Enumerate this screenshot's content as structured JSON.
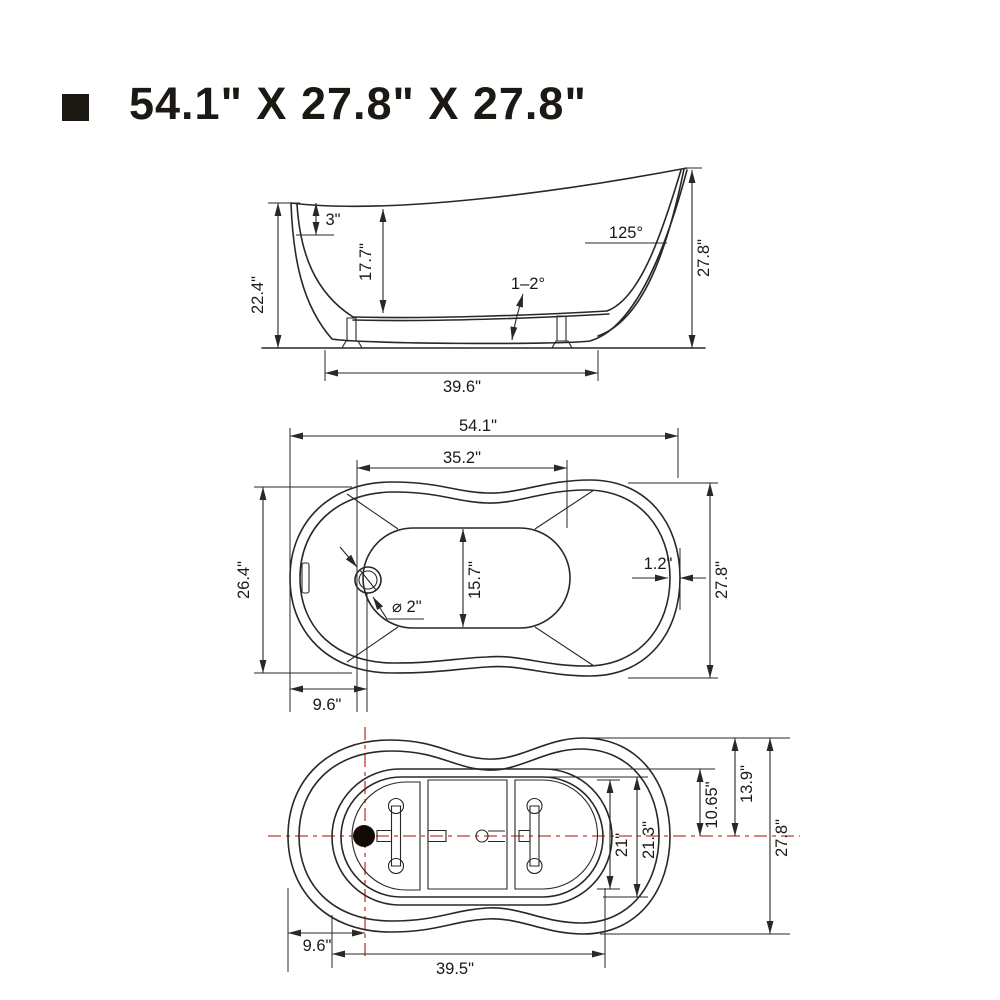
{
  "title": {
    "bullet": "square",
    "text": "54.1\" X 27.8\" X 27.8\""
  },
  "colors": {
    "line": "#2b2724",
    "text": "#1c1814",
    "centerline": "#c23a32",
    "drain_fill": "#140a05",
    "background": "#ffffff"
  },
  "product": {
    "overall_length_in": "54.1\"",
    "overall_width_in": "27.8\"",
    "overall_height_in": "27.8\""
  },
  "views": {
    "side": {
      "caption": "side-elevation-view",
      "labels": [
        {
          "text": "22.4\"",
          "x": 263,
          "y": 295,
          "rot": -90
        },
        {
          "text": "3\"",
          "x": 333,
          "y": 225,
          "rot": 0
        },
        {
          "text": "17.7\"",
          "x": 371,
          "y": 262,
          "rot": -90
        },
        {
          "text": "125°",
          "x": 626,
          "y": 238,
          "rot": 0
        },
        {
          "text": "1–2°",
          "x": 528,
          "y": 289,
          "rot": 0
        },
        {
          "text": "27.8\"",
          "x": 709,
          "y": 258,
          "rot": -90
        },
        {
          "text": "39.6\"",
          "x": 462,
          "y": 392,
          "rot": 0
        }
      ]
    },
    "plan": {
      "caption": "top-plan-view",
      "labels": [
        {
          "text": "54.1\"",
          "x": 478,
          "y": 431,
          "rot": 0
        },
        {
          "text": "35.2\"",
          "x": 462,
          "y": 463,
          "rot": 0
        },
        {
          "text": "26.4\"",
          "x": 249,
          "y": 580,
          "rot": -90
        },
        {
          "text": "15.7\"",
          "x": 480,
          "y": 580,
          "rot": -90
        },
        {
          "text": "⌀ 2\"",
          "x": 392,
          "y": 612,
          "rot": 0,
          "anchor": "start"
        },
        {
          "text": "1.2\"",
          "x": 658,
          "y": 569,
          "rot": 0
        },
        {
          "text": "27.8\"",
          "x": 727,
          "y": 580,
          "rot": -90
        },
        {
          "text": "9.6\"",
          "x": 327,
          "y": 710,
          "rot": 0
        }
      ]
    },
    "bottom": {
      "caption": "bottom-plan-view",
      "labels": [
        {
          "text": "21\"",
          "x": 627,
          "y": 845,
          "rot": -90
        },
        {
          "text": "21.3\"",
          "x": 654,
          "y": 840,
          "rot": -90
        },
        {
          "text": "10.65\"",
          "x": 717,
          "y": 805,
          "rot": -90
        },
        {
          "text": "13.9\"",
          "x": 752,
          "y": 784,
          "rot": -90
        },
        {
          "text": "27.8\"",
          "x": 787,
          "y": 838,
          "rot": -90
        },
        {
          "text": "9.6\"",
          "x": 317,
          "y": 951,
          "rot": 0
        },
        {
          "text": "39.5\"",
          "x": 455,
          "y": 974,
          "rot": 0
        }
      ]
    }
  }
}
